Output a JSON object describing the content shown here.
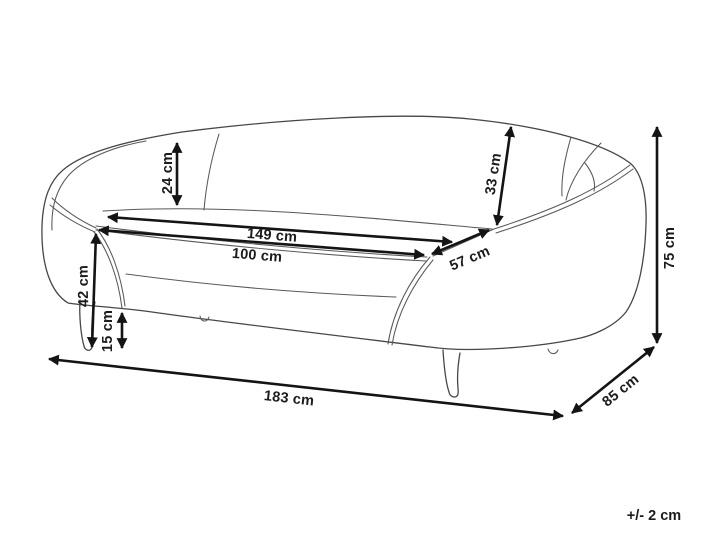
{
  "diagram": {
    "subject": "sofa-dimension-drawing",
    "unit": "cm",
    "tolerance_label": "+/- 2 cm",
    "colors": {
      "background": "#ffffff",
      "sofa_line": "#474747",
      "dimension_line": "#141414",
      "label_text": "#1c1c1c"
    },
    "dimensions": [
      {
        "id": "backrest-height-left",
        "label": "24 cm",
        "value": 24,
        "orientation": "vertical"
      },
      {
        "id": "backrest-height-right",
        "label": "33 cm",
        "value": 33,
        "orientation": "diagonal-vertical"
      },
      {
        "id": "seat-width-total",
        "label": "149 cm",
        "value": 149,
        "orientation": "horizontal"
      },
      {
        "id": "seat-width-inner",
        "label": "100 cm",
        "value": 100,
        "orientation": "horizontal"
      },
      {
        "id": "seat-depth-right",
        "label": "57 cm",
        "value": 57,
        "orientation": "diagonal"
      },
      {
        "id": "seat-height",
        "label": "42 cm",
        "value": 42,
        "orientation": "vertical"
      },
      {
        "id": "leg-height",
        "label": "15 cm",
        "value": 15,
        "orientation": "vertical"
      },
      {
        "id": "overall-width",
        "label": "183 cm",
        "value": 183,
        "orientation": "horizontal"
      },
      {
        "id": "overall-depth",
        "label": "85 cm",
        "value": 85,
        "orientation": "diagonal"
      },
      {
        "id": "overall-height",
        "label": "75 cm",
        "value": 75,
        "orientation": "vertical"
      }
    ]
  }
}
